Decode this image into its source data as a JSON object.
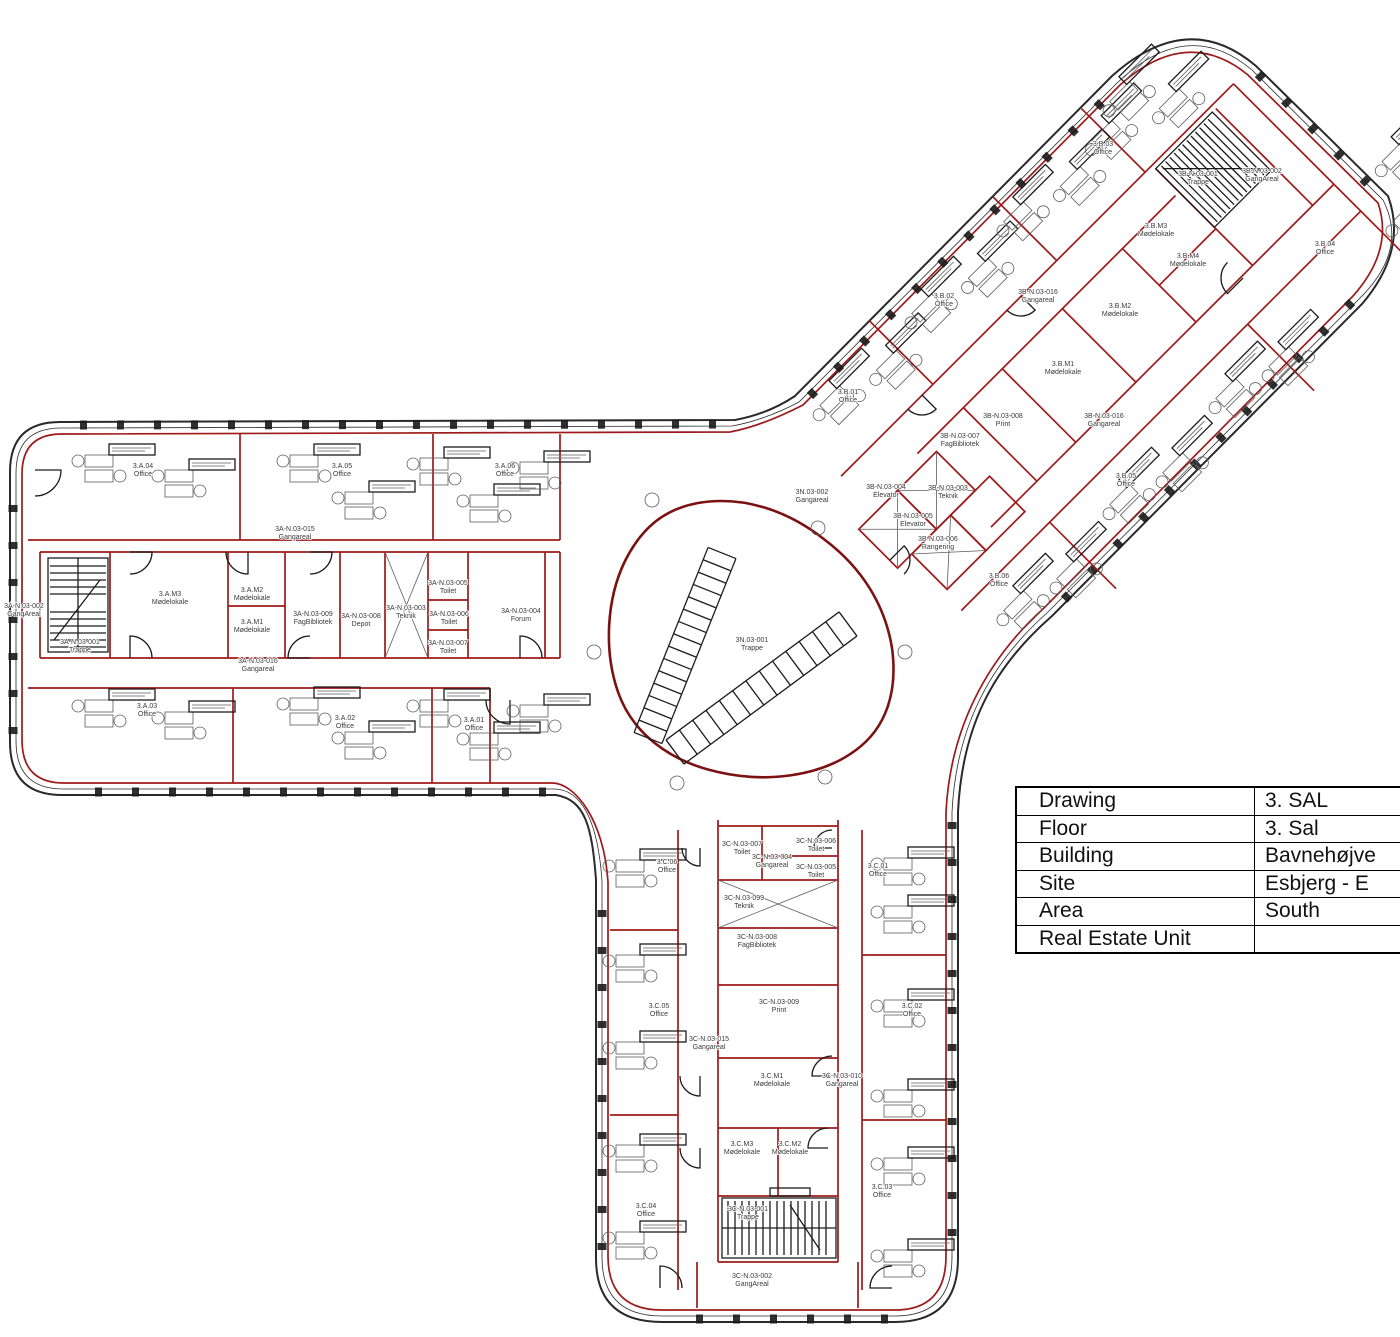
{
  "drawing": {
    "floor_title": "3. SAL",
    "units": "rooms"
  },
  "colors": {
    "wall_red": "#9e1a1a",
    "wall_dark_red": "#7c1111",
    "line_black": "#2a2a2a",
    "furniture_gray": "#5c5c5c",
    "label_text": "#3a3a3a"
  },
  "title_block": {
    "rows": [
      {
        "label": "Drawing",
        "value": "3. SAL"
      },
      {
        "label": "Floor",
        "value": "3. Sal"
      },
      {
        "label": "Building",
        "value": "Bavnehøjve"
      },
      {
        "label": "Site",
        "value": "Esbjerg - E"
      },
      {
        "label": "Area",
        "value": "South"
      },
      {
        "label": "Real Estate Unit",
        "value": ""
      }
    ]
  },
  "room_labels": [
    {
      "code": "3.A.04",
      "name": "Office",
      "x": 143,
      "y": 468
    },
    {
      "code": "3.A.05",
      "name": "Office",
      "x": 342,
      "y": 468
    },
    {
      "code": "3.A.06",
      "name": "Office",
      "x": 505,
      "y": 468
    },
    {
      "code": "3A-N.03-015",
      "name": "Gangareal",
      "x": 295,
      "y": 531
    },
    {
      "code": "3A-N.03-002",
      "name": "GangAreal",
      "x": 24,
      "y": 608
    },
    {
      "code": "3A-N.03-001",
      "name": "Trappe",
      "x": 80,
      "y": 644
    },
    {
      "code": "3.A.M3",
      "name": "Mødelokale",
      "x": 170,
      "y": 596
    },
    {
      "code": "3.A.M2",
      "name": "Mødelokale",
      "x": 252,
      "y": 592
    },
    {
      "code": "3.A.M1",
      "name": "Mødelokale",
      "x": 252,
      "y": 624
    },
    {
      "code": "3A-N.03-009",
      "name": "FagBibliotek",
      "x": 313,
      "y": 616
    },
    {
      "code": "3A-N.03-008",
      "name": "Depot",
      "x": 361,
      "y": 618
    },
    {
      "code": "3A-N.03-003",
      "name": "Teknik",
      "x": 406,
      "y": 610
    },
    {
      "code": "3A-N.03-005",
      "name": "Toilet",
      "x": 448,
      "y": 585
    },
    {
      "code": "3A-N.03-006",
      "name": "Toilet",
      "x": 449,
      "y": 616
    },
    {
      "code": "3A-N.03-007",
      "name": "Toilet",
      "x": 448,
      "y": 645
    },
    {
      "code": "3A-N.03-004",
      "name": "Forum",
      "x": 521,
      "y": 613
    },
    {
      "code": "3A-N.03-016",
      "name": "Gangareal",
      "x": 258,
      "y": 663
    },
    {
      "code": "3.A.03",
      "name": "Office",
      "x": 147,
      "y": 708
    },
    {
      "code": "3.A.02",
      "name": "Office",
      "x": 345,
      "y": 720
    },
    {
      "code": "3.A.01",
      "name": "Office",
      "x": 474,
      "y": 722
    },
    {
      "code": "3N.03-002",
      "name": "Gangareal",
      "x": 812,
      "y": 494
    },
    {
      "code": "3N.03-001",
      "name": "Trappe",
      "x": 752,
      "y": 642
    },
    {
      "code": "3.B.01",
      "name": "Office",
      "x": 848,
      "y": 394
    },
    {
      "code": "3.B.02",
      "name": "Office",
      "x": 944,
      "y": 298
    },
    {
      "code": "3.B.03",
      "name": "Office",
      "x": 1103,
      "y": 146
    },
    {
      "code": "3B-N.03-001",
      "name": "Trappe",
      "x": 1198,
      "y": 176
    },
    {
      "code": "3B-N.03-002",
      "name": "GangAreal",
      "x": 1262,
      "y": 173
    },
    {
      "code": "3.B.M3",
      "name": "Mødelokale",
      "x": 1156,
      "y": 228
    },
    {
      "code": "3.B.M4",
      "name": "Mødelokale",
      "x": 1188,
      "y": 258
    },
    {
      "code": "3.B.M2",
      "name": "Mødelokale",
      "x": 1120,
      "y": 308
    },
    {
      "code": "3.B.M1",
      "name": "Mødelokale",
      "x": 1063,
      "y": 366
    },
    {
      "code": "3B-N.03-016",
      "name": "Gangareal",
      "x": 1038,
      "y": 294
    },
    {
      "code": "3B-N.03-016",
      "name": "Gangareal",
      "x": 1104,
      "y": 418
    },
    {
      "code": "3B-N.03-008",
      "name": "Print",
      "x": 1003,
      "y": 418
    },
    {
      "code": "3B-N.03-007",
      "name": "FagBibliotek",
      "x": 960,
      "y": 438
    },
    {
      "code": "3B-N.03-004",
      "name": "Elevator",
      "x": 886,
      "y": 489
    },
    {
      "code": "3B-N.03-003",
      "name": "Teknik",
      "x": 948,
      "y": 490
    },
    {
      "code": "3B-N.03-005",
      "name": "Elevator",
      "x": 913,
      "y": 518
    },
    {
      "code": "3B-N.03-006",
      "name": "Rangering",
      "x": 938,
      "y": 541
    },
    {
      "code": "3.B.04",
      "name": "Office",
      "x": 1325,
      "y": 246
    },
    {
      "code": "3.B.05",
      "name": "Office",
      "x": 1126,
      "y": 478
    },
    {
      "code": "3.B.06",
      "name": "Office",
      "x": 999,
      "y": 578
    },
    {
      "code": "3.C.06",
      "name": "Office",
      "x": 667,
      "y": 864
    },
    {
      "code": "3C-N.03-007",
      "name": "Toilet",
      "x": 742,
      "y": 846
    },
    {
      "code": "3C-N.03-006",
      "name": "Toilet",
      "x": 816,
      "y": 843
    },
    {
      "code": "3C-N.03-004",
      "name": "Gangareal",
      "x": 772,
      "y": 859
    },
    {
      "code": "3C-N.03-005",
      "name": "Toilet",
      "x": 816,
      "y": 869
    },
    {
      "code": "3C-N.03-099",
      "name": "Teknik",
      "x": 744,
      "y": 900
    },
    {
      "code": "3C-N.03-008",
      "name": "FagBibliotek",
      "x": 757,
      "y": 939
    },
    {
      "code": "3.C.01",
      "name": "Office",
      "x": 878,
      "y": 868
    },
    {
      "code": "3.C.05",
      "name": "Office",
      "x": 659,
      "y": 1008
    },
    {
      "code": "3C-N.03-009",
      "name": "Print",
      "x": 779,
      "y": 1004
    },
    {
      "code": "3C-N.03-015",
      "name": "Gangareal",
      "x": 709,
      "y": 1041
    },
    {
      "code": "3.C.M1",
      "name": "Mødelokale",
      "x": 772,
      "y": 1078
    },
    {
      "code": "3C-N.03-010",
      "name": "Gangareal",
      "x": 842,
      "y": 1078
    },
    {
      "code": "3.C.02",
      "name": "Office",
      "x": 912,
      "y": 1008
    },
    {
      "code": "3.C.M3",
      "name": "Mødelokale",
      "x": 742,
      "y": 1146
    },
    {
      "code": "3.C.M2",
      "name": "Mødelokale",
      "x": 790,
      "y": 1146
    },
    {
      "code": "3.C.04",
      "name": "Office",
      "x": 646,
      "y": 1208
    },
    {
      "code": "3.C.03",
      "name": "Office",
      "x": 882,
      "y": 1189
    },
    {
      "code": "3C-N.03-001",
      "name": "Trappe",
      "x": 748,
      "y": 1211
    },
    {
      "code": "3C-N.03-002",
      "name": "GangAreal",
      "x": 752,
      "y": 1278
    }
  ]
}
